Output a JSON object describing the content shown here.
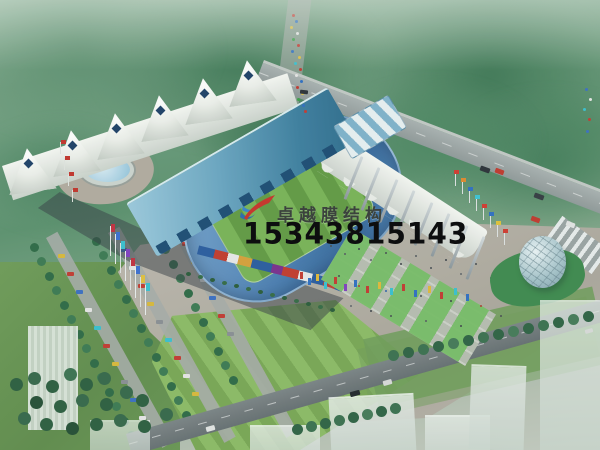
{
  "image": {
    "kind": "architectural-rendering",
    "subject": "aerial view of a membrane-structure stadium with plaza, fountain, parking, roads and glass dome"
  },
  "watermark": {
    "brand": "卓越膜结构",
    "phone": "15343815143",
    "logo": "red-swoosh-with-blue-wave",
    "brand_color": "#3b423d",
    "phone_color": "#0d0e0f"
  },
  "palette": {
    "haze_green": "#8fb49b",
    "forest_green": "#41785a",
    "lawn_green": "#83ad5e",
    "pitch_green": "#6aa84f",
    "roof_blue": "#5d9bb8",
    "seat_blue": "#4d81b5",
    "membrane_white": "#f3f5f1",
    "terrace_green": "#8fc57b",
    "plaza_gray": "#b4b0a6",
    "road_gray": "#99a2a4",
    "water_blue": "#8fc2da",
    "shadow_gray": "#3c444c"
  }
}
